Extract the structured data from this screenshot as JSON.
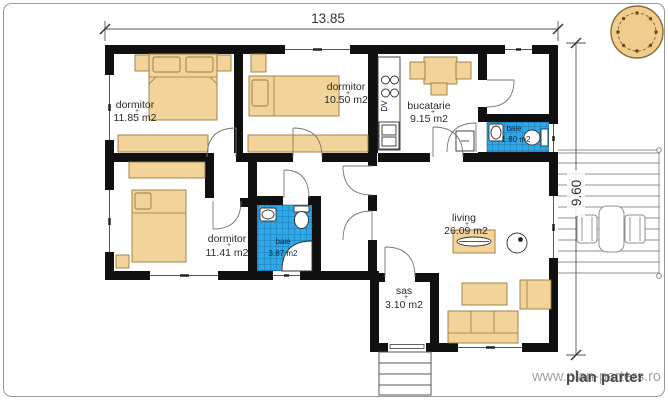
{
  "plan": {
    "dimensions": {
      "width_label": "13.85",
      "height_label": "9.60"
    },
    "rooms": {
      "bedroom1": {
        "name": "dormitor",
        "area": "11.85 m2"
      },
      "bedroom2": {
        "name": "dormitor",
        "area": "10.50 m2"
      },
      "kitchen": {
        "name": "bucatarie",
        "area": "9.15 m2"
      },
      "bath_small": {
        "name": "baie",
        "area": "1.80 m2"
      },
      "bedroom3": {
        "name": "dormitor",
        "area": "11.41 m2"
      },
      "bath_main": {
        "name": "baie",
        "area": "3.87 m2"
      },
      "living": {
        "name": "living",
        "area": "26.09 m2"
      },
      "vestibule": {
        "name": "sas",
        "area": "3.10 m2"
      }
    },
    "labels": {
      "kitchen_dv": "DV",
      "area_marker": "+"
    },
    "watermark": {
      "url_text": "www.plan-parters.ro",
      "brand_text": "plan parter"
    },
    "colors": {
      "wall": "#101010",
      "furniture": "#f2d49a",
      "tile_blue": "#2fa8e8",
      "tile_grid": "#1b7ab8",
      "compass_fill": "#f0cd8e",
      "watermark_gray": "#a3a3a3"
    }
  }
}
